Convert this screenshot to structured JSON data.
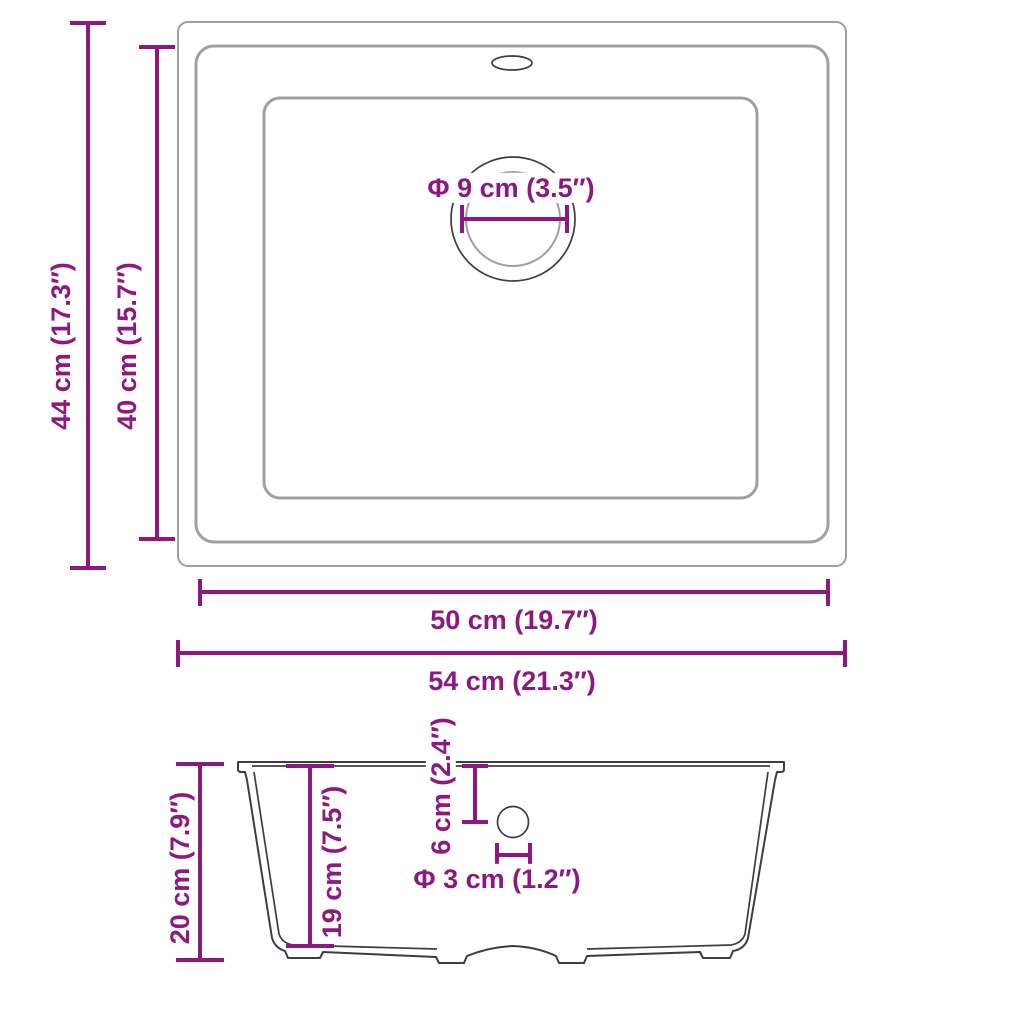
{
  "diagram": {
    "title": "Kitchen sink dimension drawing",
    "accent_color": "#8C1880",
    "outline_color": "#3D3D3D",
    "soft_outline_color": "#A0A0A0"
  },
  "top_view": {
    "outer_height_label": "44 cm (17.3″)",
    "rim_height_label": "40 cm (15.7″)",
    "rim_width_label": "50 cm (19.7″)",
    "outer_width_label": "54 cm (21.3″)",
    "drain_diameter_label": "Φ 9 cm (3.5″)"
  },
  "side_view": {
    "total_height_label": "20 cm (7.9″)",
    "basin_depth_label": "19 cm (7.5″)",
    "hole_offset_label": "6 cm (2.4″)",
    "hole_diameter_label": "Φ 3 cm (1.2″)"
  }
}
